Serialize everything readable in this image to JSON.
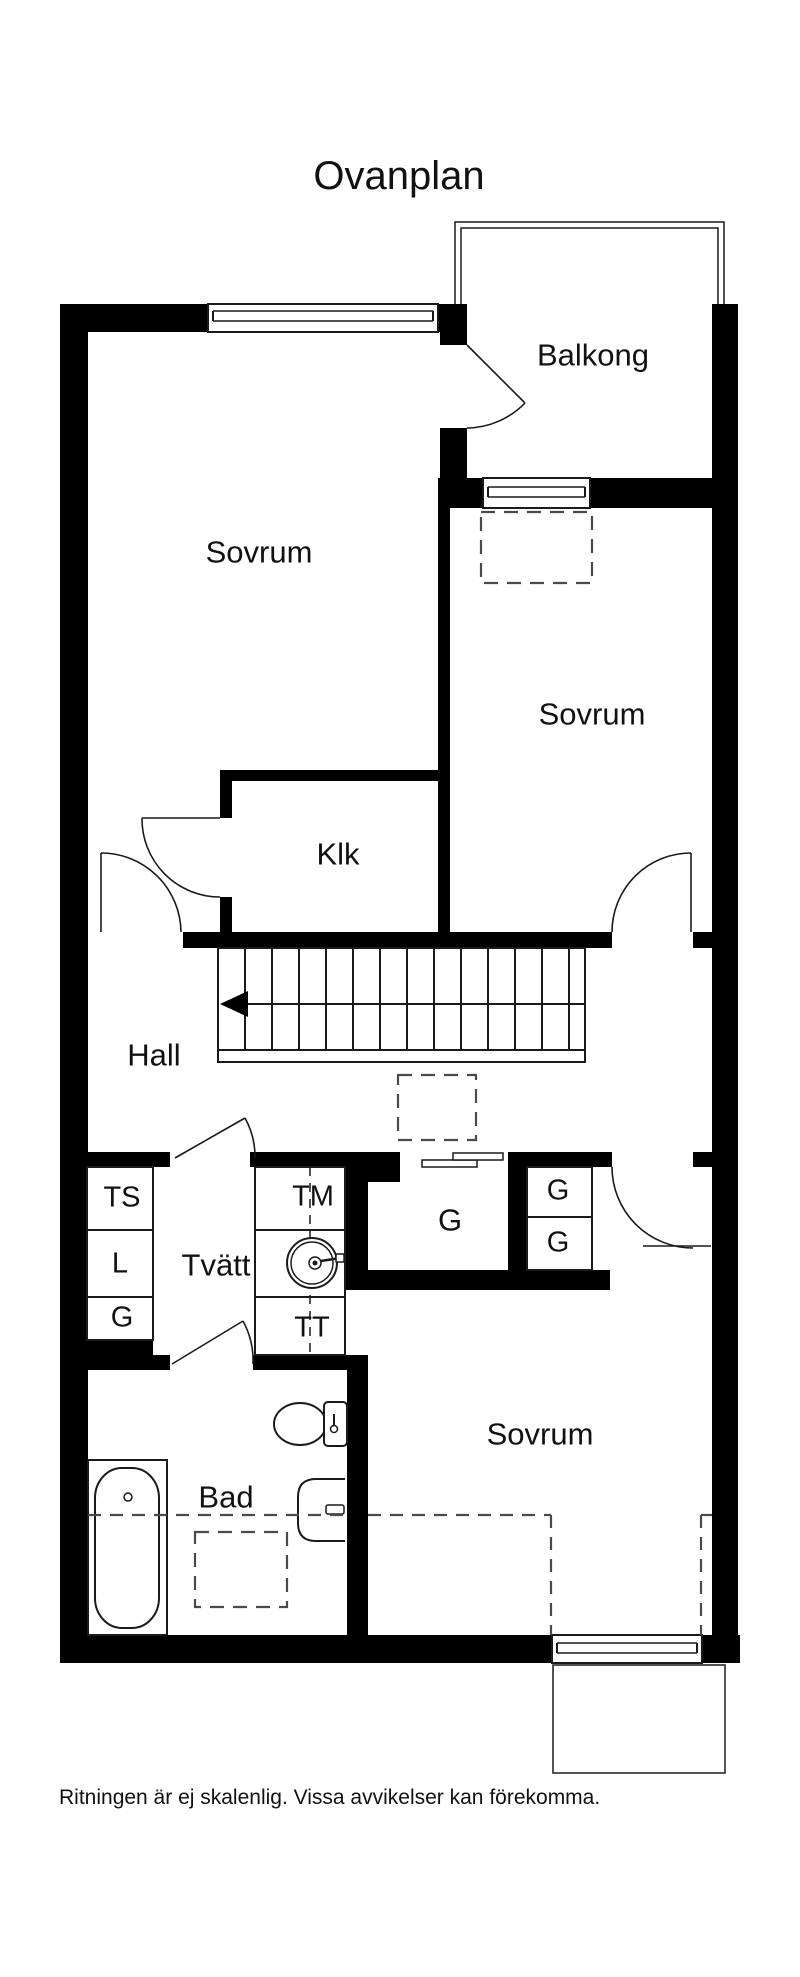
{
  "title": "Ovanplan",
  "caption": "Ritningen är ej skalenlig. Vissa avvikelser kan förekomma.",
  "rooms": {
    "balkong": "Balkong",
    "sovrum1": "Sovrum",
    "sovrum2": "Sovrum",
    "sovrum3": "Sovrum",
    "klk": "Klk",
    "hall": "Hall",
    "tvatt": "Tvätt",
    "bad": "Bad",
    "g_room": "G",
    "g_right_top": "G",
    "g_right_bottom": "G",
    "ts": "TS",
    "l": "L",
    "g_left": "G",
    "tm": "TM",
    "tt": "TT"
  },
  "colors": {
    "wall": "#000000",
    "thin_line": "#1a1a1a",
    "dashed_line": "#4a4a4a",
    "background": "#ffffff"
  }
}
